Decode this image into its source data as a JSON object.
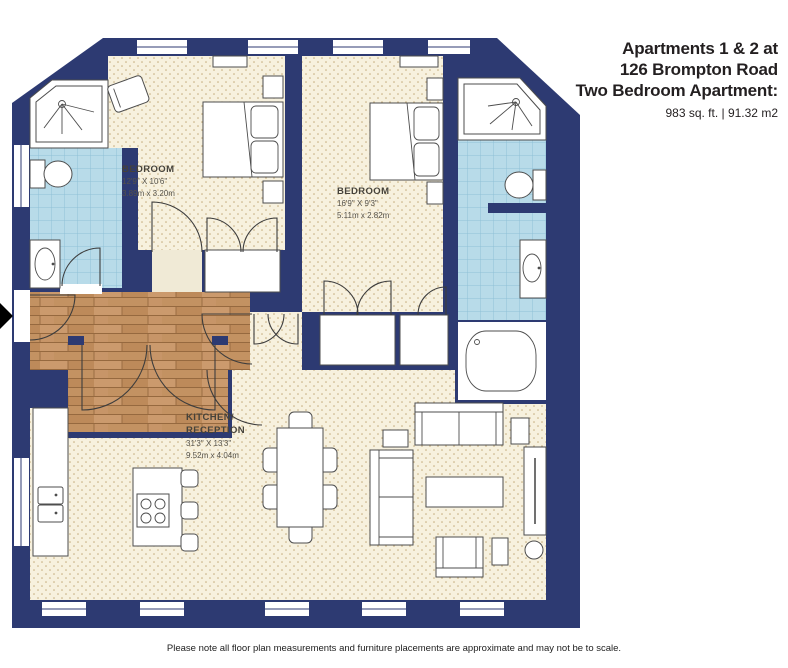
{
  "header": {
    "title_line1": "Apartments 1 & 2 at",
    "title_line2": "126 Brompton Road",
    "title_line3": "Two Bedroom Apartment:",
    "area": "983 sq. ft. | 91.32 m2"
  },
  "rooms": {
    "bedroom1": {
      "name": "BEDROOM",
      "imperial": "12'9\" X 10'6\"",
      "metric": "3.89m x 3.20m"
    },
    "bedroom2": {
      "name": "BEDROOM",
      "imperial": "16'9\" X 9'3\"",
      "metric": "5.11m x 2.82m"
    },
    "kitchen": {
      "name_line1": "KITCHEN/",
      "name_line2": "RECEPTION",
      "imperial": "31'3\" X 13'3\"",
      "metric": "9.52m x 4.04m"
    }
  },
  "footer": {
    "note": "Please note all floor plan measurements and furniture placements are approximate and may not be to scale."
  },
  "palette": {
    "wall": "#2d3a72",
    "floor_cream": "#f7f1de",
    "tile_blue": "#b8dbe9",
    "wood": "#c39262",
    "text": "#231f20"
  }
}
